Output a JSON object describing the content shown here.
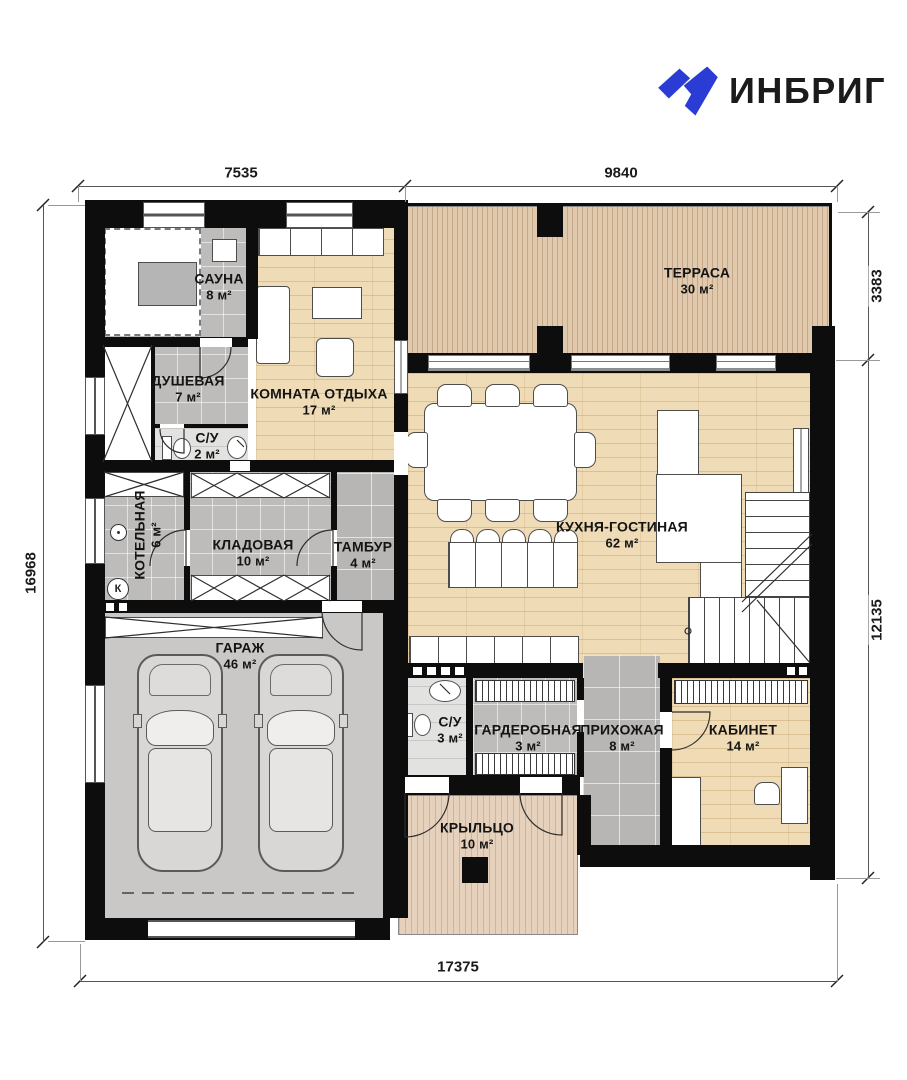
{
  "brand": {
    "name": "ИНБРИГ"
  },
  "dimensions": {
    "top": [
      "7535",
      "9840"
    ],
    "left": "16968",
    "right": [
      "3383",
      "12135"
    ],
    "bottom": "17375"
  },
  "rooms": {
    "sauna": {
      "name": "САУНА",
      "area": "8 м²"
    },
    "shower": {
      "name": "ДУШЕВАЯ",
      "area": "7 м²"
    },
    "wc_small": {
      "name": "С/У",
      "area": "2 м²"
    },
    "lounge": {
      "name": "КОМНАТА ОТДЫХА",
      "area": "17 м²"
    },
    "terrace": {
      "name": "ТЕРРАСА",
      "area": "30 м²"
    },
    "boiler": {
      "name": "КОТЕЛЬНАЯ",
      "area": "6 м²"
    },
    "storage": {
      "name": "КЛАДОВАЯ",
      "area": "10 м²"
    },
    "vestibule": {
      "name": "ТАМБУР",
      "area": "4 м²"
    },
    "kitchen_living": {
      "name": "КУХНЯ-ГОСТИНАЯ",
      "area": "62 м²"
    },
    "garage": {
      "name": "ГАРАЖ",
      "area": "46 м²"
    },
    "wc": {
      "name": "С/У",
      "area": "3 м²"
    },
    "wardrobe": {
      "name": "ГАРДЕРОБНАЯ",
      "area": "3 м²"
    },
    "hallway": {
      "name": "ПРИХОЖАЯ",
      "area": "8 м²"
    },
    "office": {
      "name": "КАБИНЕТ",
      "area": "14 м²"
    },
    "porch": {
      "name": "КРЫЛЬЦО",
      "area": "10 м²"
    }
  },
  "symbols": {
    "boiler_mark": "К"
  },
  "colors": {
    "wall": "#0d0d0d",
    "wood": "#efdcb6",
    "deck": "#e0c9ad",
    "tile": "#bdbcbb",
    "garage_floor": "#c9c8c7",
    "brand_blue": "#2a3cd4"
  }
}
